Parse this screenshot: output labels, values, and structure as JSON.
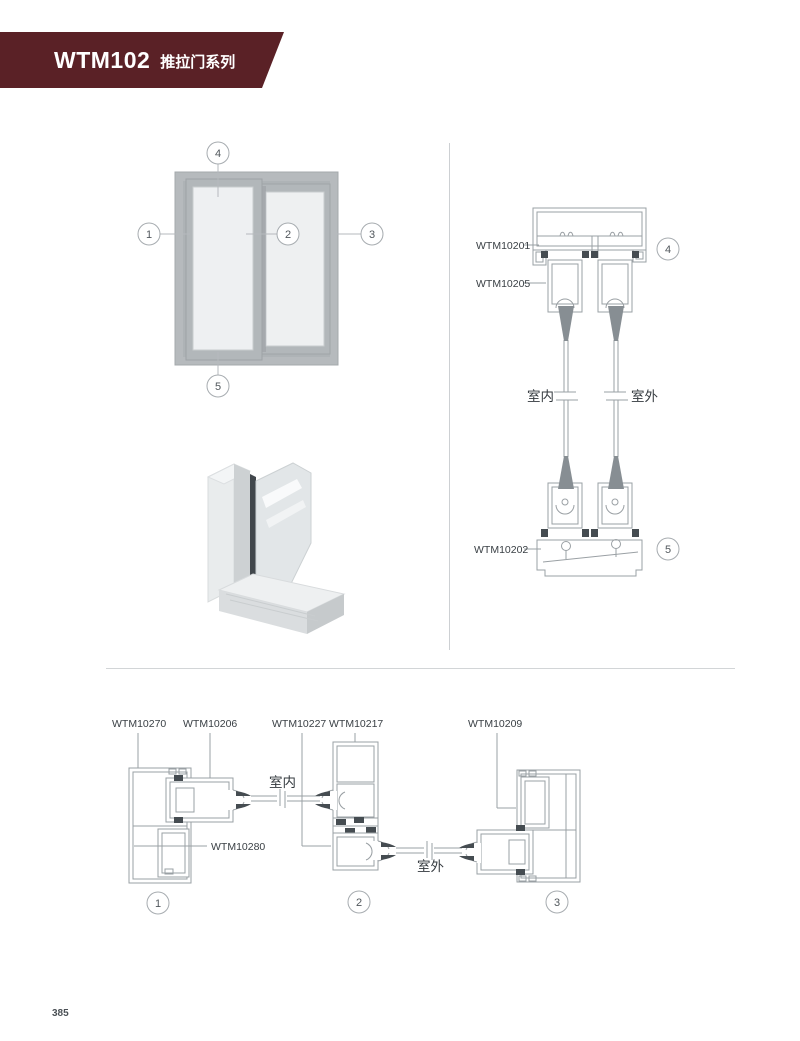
{
  "header": {
    "code": "WTM102",
    "series": "推拉门系列",
    "banner_color": "#5a2126"
  },
  "page": {
    "number": "385"
  },
  "elevation": {
    "callouts": {
      "c1": "1",
      "c2": "2",
      "c3": "3",
      "c4": "4",
      "c5": "5"
    }
  },
  "vertical_section": {
    "top_track_label": "WTM10201",
    "top_sash_label": "WTM10205",
    "bottom_track_label": "WTM10202",
    "indoor_label": "室内",
    "outdoor_label": "室外",
    "callout_top": "4",
    "callout_bottom": "5"
  },
  "horizontal_section": {
    "left_frame_label": "WTM10270",
    "left_sash_label": "WTM10206",
    "interlock_label_a": "WTM10227",
    "interlock_label_b": "WTM10217",
    "right_frame_label": "WTM10209",
    "insert_label": "WTM10280",
    "indoor_label": "室内",
    "outdoor_label": "室外",
    "callout_left": "1",
    "callout_center": "2",
    "callout_right": "3"
  },
  "colors": {
    "line": "#9aa0a4",
    "dark_gasket": "#454c51",
    "label_text": "#3a4045",
    "glass_fill": "#eef0f1",
    "frame_gray": "#b4b8bb"
  }
}
